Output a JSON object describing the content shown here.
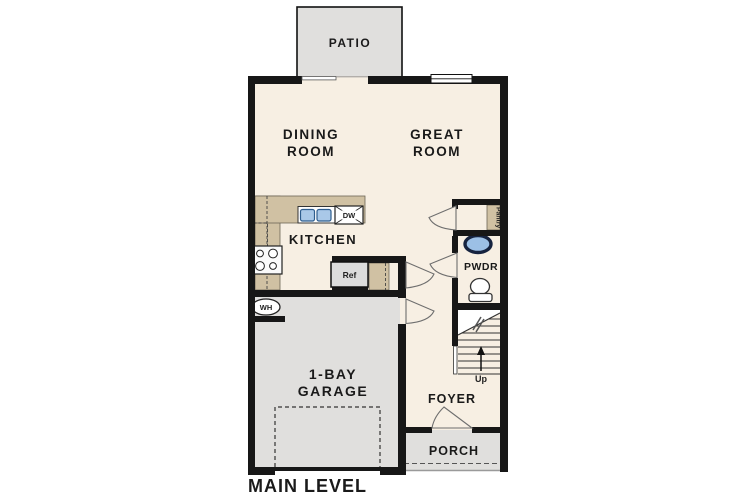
{
  "plan": {
    "level_title": "MAIN LEVEL",
    "rooms": {
      "patio": {
        "label": "PATIO"
      },
      "dining": {
        "label_line1": "DINING",
        "label_line2": "ROOM"
      },
      "great": {
        "label_line1": "GREAT",
        "label_line2": "ROOM"
      },
      "kitchen": {
        "label": "KITCHEN"
      },
      "pantry": {
        "label": "Pantry"
      },
      "powder": {
        "label": "PWDR"
      },
      "garage": {
        "label_line1": "1-BAY",
        "label_line2": "GARAGE"
      },
      "foyer": {
        "label": "FOYER"
      },
      "porch": {
        "label": "PORCH"
      }
    },
    "fixtures": {
      "dishwasher_label": "DW",
      "refrigerator_label": "Ref",
      "water_heater_label": "WH",
      "stairs_direction_label": "Up"
    },
    "colors": {
      "floor": "#f7efe3",
      "counter": "#d0c1a3",
      "exterior_gray": "#e0dfdd",
      "wall": "#171717",
      "sink_blue": "#a9c8e8",
      "pwdr_sink_blue": "#9cc0e6"
    }
  }
}
